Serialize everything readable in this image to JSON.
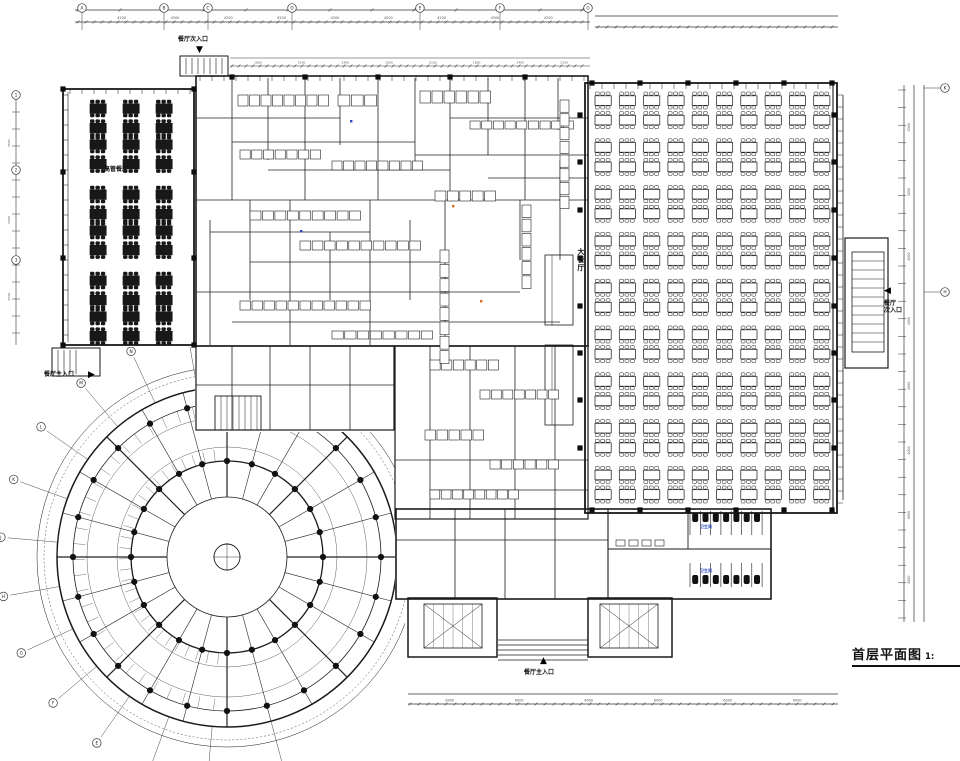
{
  "drawing": {
    "title": "首层平面图",
    "title_scale": "1:",
    "labels": [
      {
        "name": "room-label-executive-dining",
        "text": "高管餐厅",
        "x": 104,
        "y": 167,
        "size": 6,
        "color": "#111"
      },
      {
        "name": "room-label-main-dining",
        "text": "大餐厅",
        "x": 576,
        "y": 248,
        "size": 7,
        "color": "#111",
        "vertical": true
      },
      {
        "name": "room-label-toilet-1",
        "text": "卫生间",
        "x": 700,
        "y": 525,
        "size": 4,
        "color": "#2b48c0"
      },
      {
        "name": "room-label-toilet-2",
        "text": "卫生间",
        "x": 700,
        "y": 569,
        "size": 4,
        "color": "#2b48c0"
      }
    ],
    "entrances": [
      {
        "name": "entrance-top-secondary",
        "text": "餐厅次入口",
        "arrow": "▼",
        "tx": 178,
        "ty": 37,
        "ax": 196,
        "ay": 45,
        "size": 6
      },
      {
        "name": "entrance-left-main",
        "text": "餐厅主入口",
        "arrow": "▶",
        "tx": 44,
        "ty": 372,
        "ax": 88,
        "ay": 370,
        "size": 6
      },
      {
        "name": "entrance-right-secondary",
        "text": "餐厅\n次入口",
        "arrow": "◀",
        "tx": 884,
        "ty": 301,
        "ax": 884,
        "ay": 286,
        "size": 6
      },
      {
        "name": "entrance-bottom-main",
        "text": "餐厅主入口",
        "arrow": "▲",
        "tx": 524,
        "ty": 670,
        "ax": 540,
        "ay": 656,
        "size": 6
      }
    ],
    "dim_numbers": {
      "top": [
        "4200",
        "4500",
        "4200",
        "8100",
        "4200",
        "4500",
        "4200",
        "4500",
        "4200"
      ],
      "mid": [
        "1800",
        "2100",
        "2400",
        "1500",
        "2100",
        "1800",
        "2400",
        "2100"
      ],
      "right": [
        "4000",
        "4000",
        "4000",
        "4000",
        "4000",
        "4000",
        "8000",
        "4000"
      ],
      "bottom": [
        "6000",
        "6000",
        "6000",
        "6000",
        "6000",
        "6000"
      ],
      "left": [
        "4500",
        "4200",
        "4500"
      ]
    },
    "grid_bubbles": {
      "top": [
        "A",
        "B",
        "C",
        "D",
        "E",
        "F",
        "G"
      ],
      "right": [
        "K",
        "H"
      ],
      "left": [
        "1",
        "2",
        "3"
      ],
      "circle": [
        "B",
        "C",
        "D",
        "E",
        "F",
        "G",
        "H",
        "J",
        "K",
        "L",
        "M",
        "N",
        "P"
      ]
    },
    "furniture": {
      "main_hall": {
        "cols": 10,
        "rows": 9,
        "x0": 595,
        "y0": 92,
        "dx": 24.3,
        "dy": 46.8,
        "style": "outline"
      },
      "exec_room": {
        "xs": [
          90,
          123,
          156
        ],
        "ys": [
          100,
          136,
          186,
          222,
          272,
          308
        ],
        "style": "dark"
      }
    },
    "colors": {
      "line": "#1a1a1a",
      "dim": "#555555",
      "accent_blue": "#2b48c0",
      "accent_orange": "#d86b1f"
    }
  }
}
